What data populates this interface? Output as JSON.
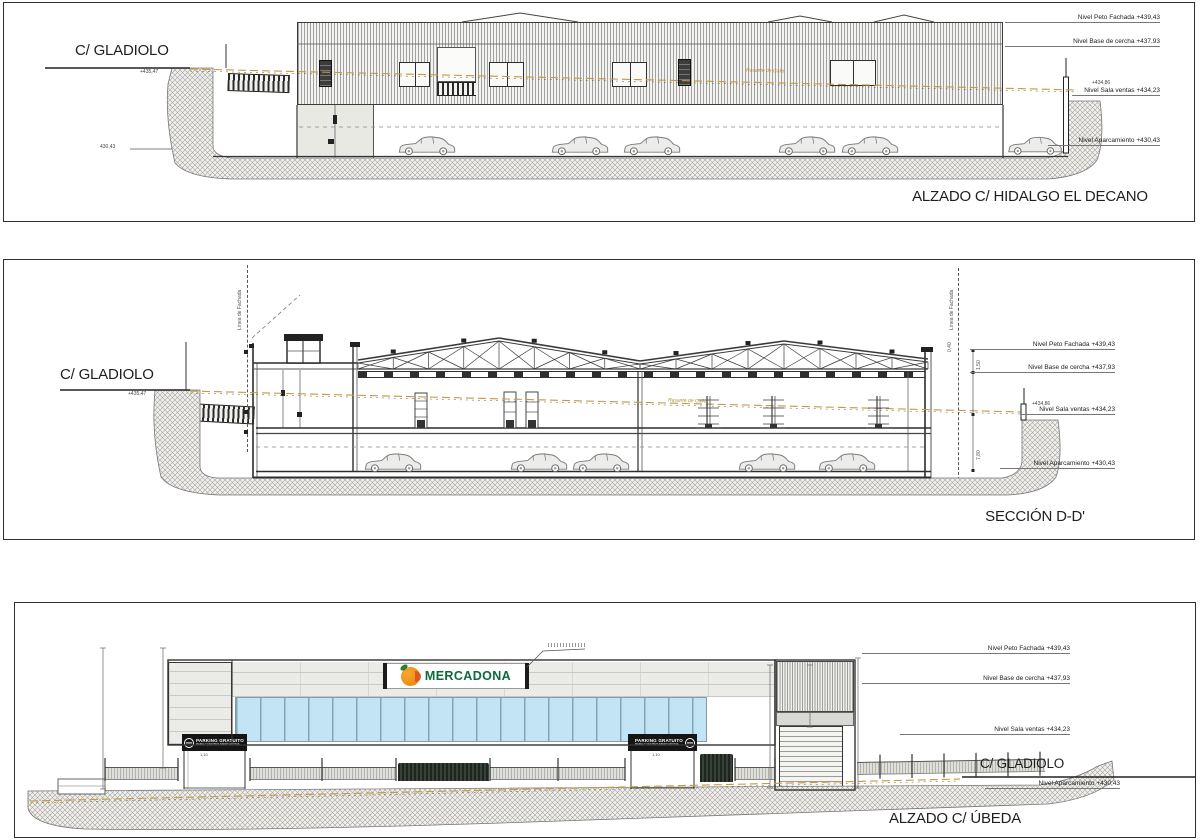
{
  "streets": {
    "gladiolo": "C/ GLADIOLO"
  },
  "levels": {
    "peto": "Nivel Peto Fachada +439,43",
    "cercha": "Nivel Base de cercha +437,93",
    "sala_mark": "+434,86",
    "sala": "Nivel Sala ventas +434,23",
    "aparcamiento": "Nivel Aparcamiento +430,43"
  },
  "annotations": {
    "street_level": "+435,47",
    "apark_small": "430,43",
    "rasante": "Rasante de Calle",
    "linea_fachada": "Línea de Fachada"
  },
  "dims": {
    "parapet": "0,40",
    "peto_cercha": "1,50",
    "sala_apark": "7,80",
    "door": "1,10"
  },
  "panel1": {
    "title": "ALZADO C/ HIDALGO EL DECANO"
  },
  "panel2": {
    "title": "SECCIÓN D-D'"
  },
  "panel3": {
    "title": "ALZADO C/ ÚBEDA",
    "brand": "MERCADONA",
    "sign": {
      "line1": "PARKING GRATUITO",
      "line2": "PARA CLIENTES MERCADONA"
    }
  }
}
